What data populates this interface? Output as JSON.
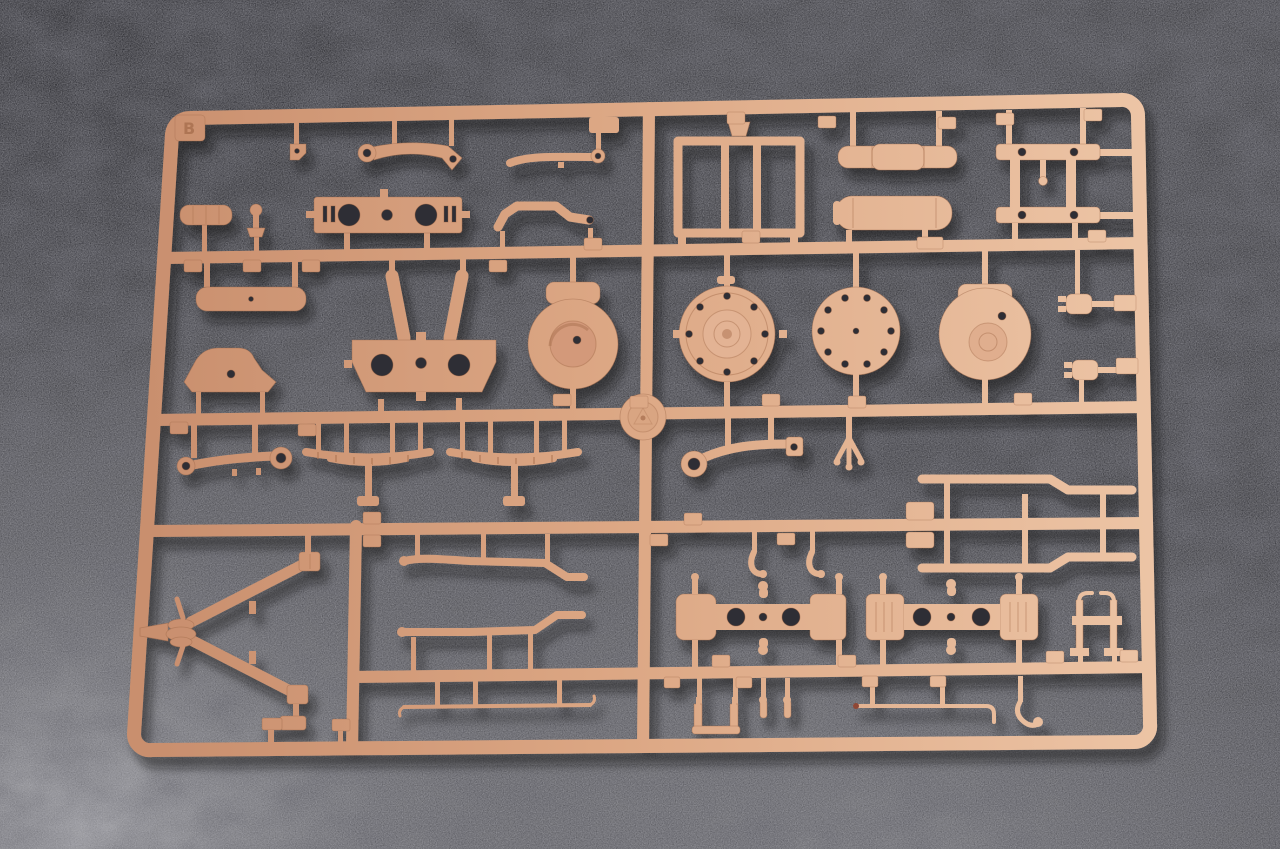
{
  "scene": {
    "type": "photograph",
    "subject": "Tan plastic injection-molded model-kit sprue (parts tree) photographed top-down on dark gray carpet",
    "description": "Overhead photo of a sand/tan colored plastic model kit sprue frame full of unassembled parts, lying on a dark gray carpet-like textured surface; light falls from upper left leaving the lower-left and bottom of the carpet brighter",
    "background": "dark charcoal carpet texture, brighter toward bottom-left corner and bottom edge",
    "no_visible_ui": true
  },
  "colors": {
    "plastic_light": "#EDC5A6",
    "plastic_mid": "#DCA784",
    "plastic_deep": "#C98F6E",
    "plastic_shadow": "#9C6546",
    "carpet_base": "#3E3E43",
    "carpet_dark": "#2A2A2F",
    "carpet_light": "#A3A3A8",
    "hole_dark": "#2E2E34"
  },
  "sprue": {
    "letter": "B",
    "material": "tan injection-molded styrene",
    "frame": "rounded-rectangle outer frame, slightly tilted in the photo",
    "runners": {
      "horizontal": 4,
      "vertical": 2,
      "center_hub": "round molding hub with faint embossed mold mark at the sprue center"
    },
    "part_number_tabs": {
      "style": "small raised rectangular tabs with embossed part numbers along the runners",
      "approx_count": 36,
      "numbers_legible": false
    },
    "parts": [
      {
        "name": "corner-letter-tab",
        "desc": "tab embossed with the sprue letter",
        "area": "top-left corner"
      },
      {
        "name": "small-angled-bracket",
        "desc": "tiny bracket with hole",
        "area": "top row left"
      },
      {
        "name": "curved-control-arm",
        "desc": "arm with round eyelet and angled drilled head",
        "area": "top row left"
      },
      {
        "name": "eye-end-rod",
        "desc": "slim bar ending in a small eyelet",
        "area": "top row center"
      },
      {
        "name": "drilled-mounting-plate",
        "desc": "rectangular plate, two large holes, one small center hole, end slots",
        "area": "upper left"
      },
      {
        "name": "stepped-bracket",
        "desc": "bracket with raised hump and eye hole",
        "area": "upper center"
      },
      {
        "name": "ribbed-silencer-cylinder",
        "desc": "small ribbed cylinder",
        "area": "upper far left"
      },
      {
        "name": "ball-head-post",
        "desc": "short post with ball top and flared base",
        "area": "upper far left"
      },
      {
        "name": "ladder-frame",
        "desc": "rectangular frame with inner vertical slats",
        "area": "top right quadrant"
      },
      {
        "name": "three-segment-roller",
        "desc": "cylinder made of three segments",
        "area": "top right"
      },
      {
        "name": "tank-cylinder",
        "desc": "cylinder with domed ends and seam rings",
        "area": "top right"
      },
      {
        "name": "double-bar-bracket",
        "desc": "two drilled bars joined by vertical posts with hanging pin",
        "area": "top far right"
      },
      {
        "name": "plain-tube",
        "desc": "smooth tube with tiny center hole",
        "area": "middle left"
      },
      {
        "name": "a-frame-carrier",
        "desc": "two legs over a drilled trapezoid plate",
        "area": "middle left-center"
      },
      {
        "name": "volute-drum-housing",
        "desc": "round drum with spiral (volute) face and top block",
        "area": "middle center"
      },
      {
        "name": "arched-bracket",
        "desc": "low arched bracket with small hole",
        "area": "middle far left"
      },
      {
        "name": "flanged-bolt-disc",
        "desc": "disc with 8 rim bolt holes and raised center dome",
        "area": "middle right of center"
      },
      {
        "name": "flat-bolt-disc",
        "desc": "flat disc with 10 rim bolt holes",
        "area": "middle right"
      },
      {
        "name": "drum-cover-disc",
        "desc": "disc with hinge block and offset boss",
        "area": "middle far right"
      },
      {
        "name": "small-shackle-upper",
        "desc": "small knobby connector",
        "area": "right edge upper"
      },
      {
        "name": "small-shackle-lower",
        "desc": "small knobby connector",
        "area": "right edge lower"
      },
      {
        "name": "double-eyelet-link",
        "desc": "link bar with eyelets at both ends",
        "area": "mid-left band"
      },
      {
        "name": "leaf-spring-left",
        "desc": "segmented leaf spring arc with center post",
        "area": "mid band"
      },
      {
        "name": "leaf-spring-right",
        "desc": "segmented leaf spring arc with center post",
        "area": "mid band"
      },
      {
        "name": "large-eyelet-lever",
        "desc": "lever with big eyelet and drilled end block",
        "area": "mid band right of center"
      },
      {
        "name": "three-prong-fork",
        "desc": "small fork with three toes",
        "area": "mid band right"
      },
      {
        "name": "z-step-rail-upper",
        "desc": "long rail with Z step",
        "area": "right, above third runner"
      },
      {
        "name": "z-step-rail-lower",
        "desc": "long rail with mirrored Z step",
        "area": "right, below third runner"
      },
      {
        "name": "hook-clamp-pair",
        "desc": "two small J-hooks",
        "area": "below third runner, center-right"
      },
      {
        "name": "v-trail-assembly",
        "desc": "V-shaped trail legs with layered pivot hub, blade and clevis ends",
        "area": "lower left box"
      },
      {
        "name": "step-rod-upper",
        "desc": "long rod with end step",
        "area": "lower center"
      },
      {
        "name": "step-rod-lower",
        "desc": "long rod with mirrored end step",
        "area": "lower center"
      },
      {
        "name": "thin-tie-rod",
        "desc": "very thin rod with hooked tips",
        "area": "lower center"
      },
      {
        "name": "axle-bracket-plain",
        "desc": "bow-tie axle part, two large holes, mushroom pegs",
        "area": "lower right"
      },
      {
        "name": "axle-bracket-ribbed",
        "desc": "bow-tie axle part with ribbed end blocks",
        "area": "lower right"
      },
      {
        "name": "h-stand",
        "desc": "small H-shaped stand with hooked tops",
        "area": "lower far right"
      },
      {
        "name": "u-bracket",
        "desc": "small U channel",
        "area": "bottom row"
      },
      {
        "name": "pin-pair",
        "desc": "two short round-head pins",
        "area": "bottom row"
      },
      {
        "name": "l-bent-wire-rod",
        "desc": "thin rod with right-angle end",
        "area": "bottom row"
      },
      {
        "name": "j-hook",
        "desc": "curved hook with ball tip",
        "area": "bottom row right"
      }
    ]
  }
}
